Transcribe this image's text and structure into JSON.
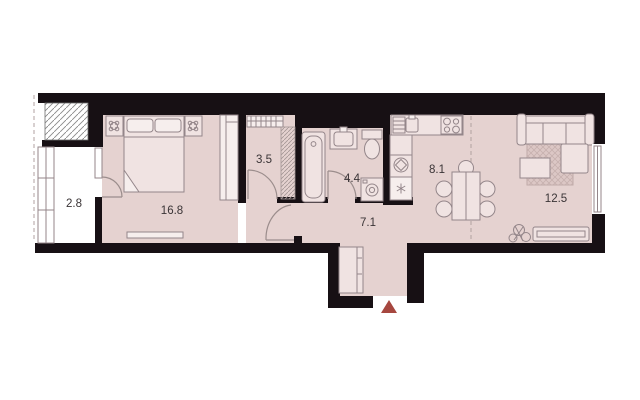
{
  "floorplan": {
    "colors": {
      "wall": "#171014",
      "floor": "#e5d2d0",
      "balcony": "#ffffff",
      "furn-fill": "#f0e3e2",
      "furn-stroke": "#94868a",
      "door": "#9b8d8c",
      "line": "#b1a2a1",
      "label": "#3a3436",
      "marker": "#a6473f"
    },
    "rooms": [
      {
        "id": "balcony",
        "area": "2.8"
      },
      {
        "id": "bedroom",
        "area": "16.8"
      },
      {
        "id": "wardrobe",
        "area": "3.5"
      },
      {
        "id": "bathroom",
        "area": "4.4"
      },
      {
        "id": "hallway",
        "area": "7.1"
      },
      {
        "id": "kitchen",
        "area": "8.1"
      },
      {
        "id": "living-room",
        "area": "12.5"
      }
    ],
    "entrance_marker": {
      "shape": "triangle-up",
      "color": "#a6473f"
    }
  }
}
